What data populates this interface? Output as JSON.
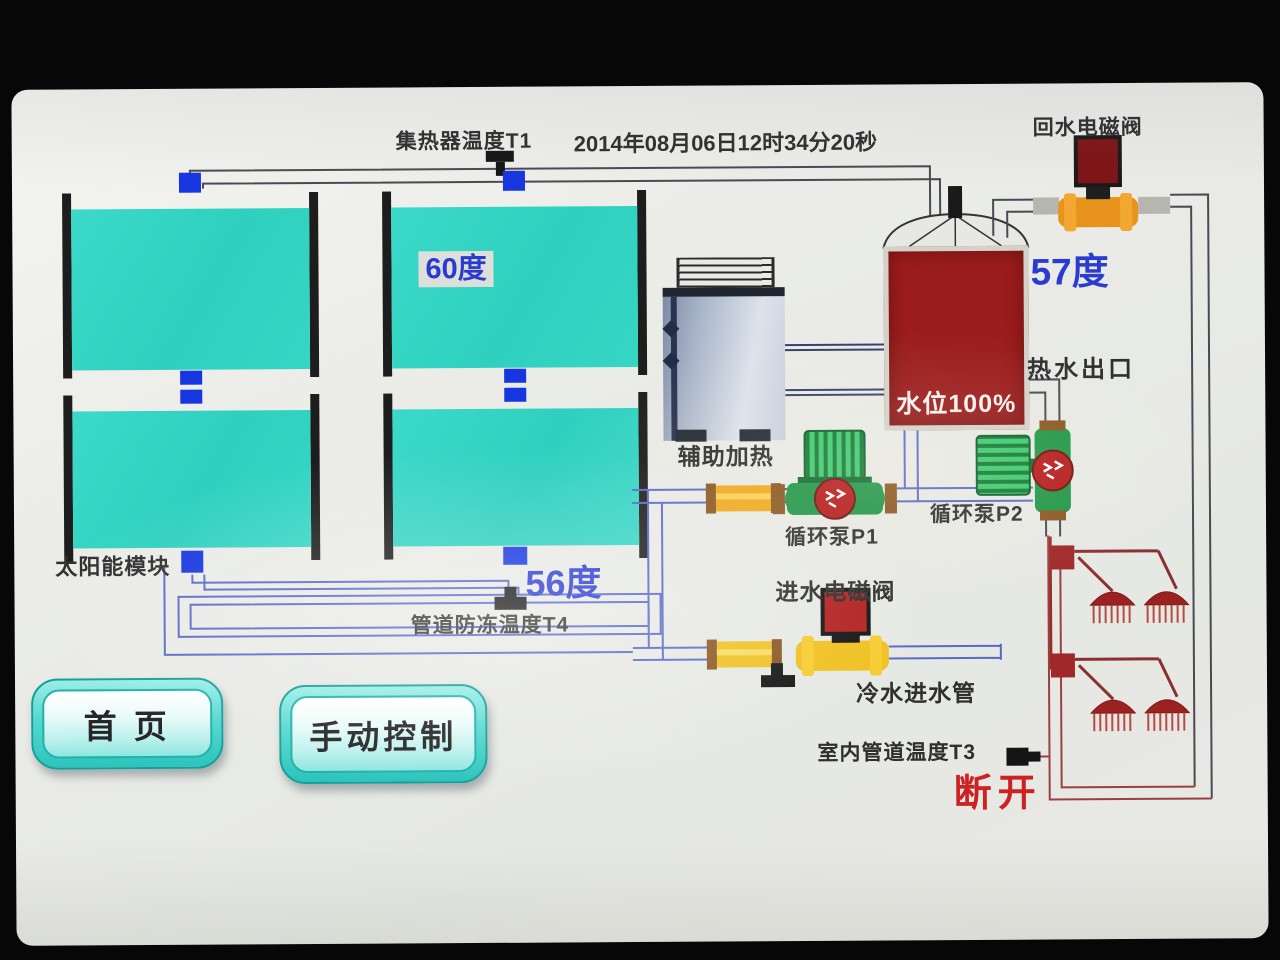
{
  "header": {
    "collector_temp_label": "集热器温度T1",
    "datetime": "2014年08月06日12时34分20秒"
  },
  "solar": {
    "module_label": "太阳能模块",
    "panel_temp": "60度"
  },
  "antifreeze": {
    "temp": "56度",
    "sensor_label": "管道防冻温度T4"
  },
  "heater": {
    "label": "辅助加热"
  },
  "tank": {
    "level_text": "水位100%",
    "temp": "57度",
    "hot_water_outlet_label": "热水出口"
  },
  "return_valve": {
    "label": "回水电磁阀"
  },
  "inlet_valve": {
    "label": "进水电磁阀",
    "cold_water_label": "冷水进水管"
  },
  "pumps": {
    "p1_label": "循环泵P1",
    "p2_label": "循环泵P2"
  },
  "indoor": {
    "sensor_label": "室内管道温度T3",
    "status": "断开"
  },
  "buttons": {
    "home": "首 页",
    "manual": "手动控制"
  },
  "colors": {
    "panel_cyan": "#35d2c2",
    "tank_red": "#9b1c1c",
    "accent_blue": "#2b3bd0",
    "status_red": "#cc2222",
    "pump_green": "#1f9646",
    "valve_yellow": "#f0c020",
    "valve_orange": "#e8941c",
    "pipe_blue": "#5868c8",
    "shower_maroon": "#9a4040"
  }
}
